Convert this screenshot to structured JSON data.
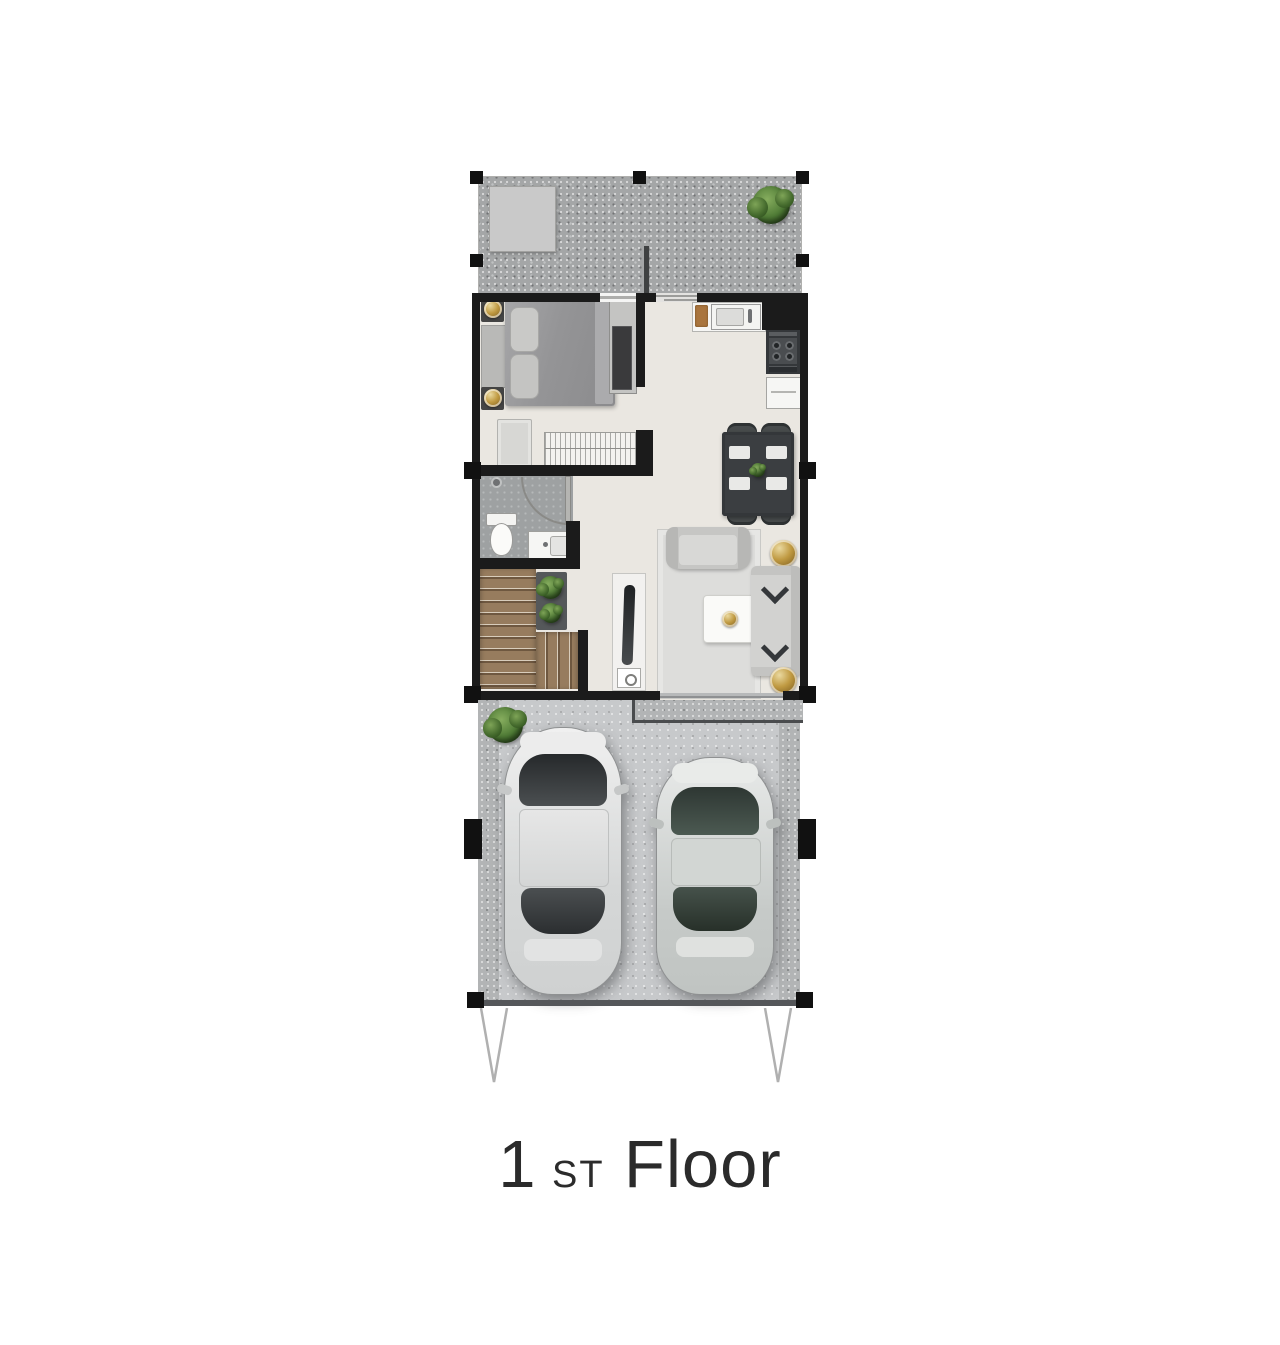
{
  "title": {
    "number": "1",
    "ordinal_suffix": "st",
    "word": "Floor"
  },
  "palette": {
    "wall": "#1b1b1b",
    "interior_floor": "#eae7e1",
    "terrace_gravel": "#a4a6a7",
    "carport_concrete": "#c7c9cb",
    "bathroom_floor": "#9ea1a2",
    "stair_wood": "#977c5e",
    "accent_gold": "#c09a42",
    "plant_green": "#4e7a35",
    "car_body_silver": "#e8eae9",
    "title_text": "#2b2b2b"
  }
}
